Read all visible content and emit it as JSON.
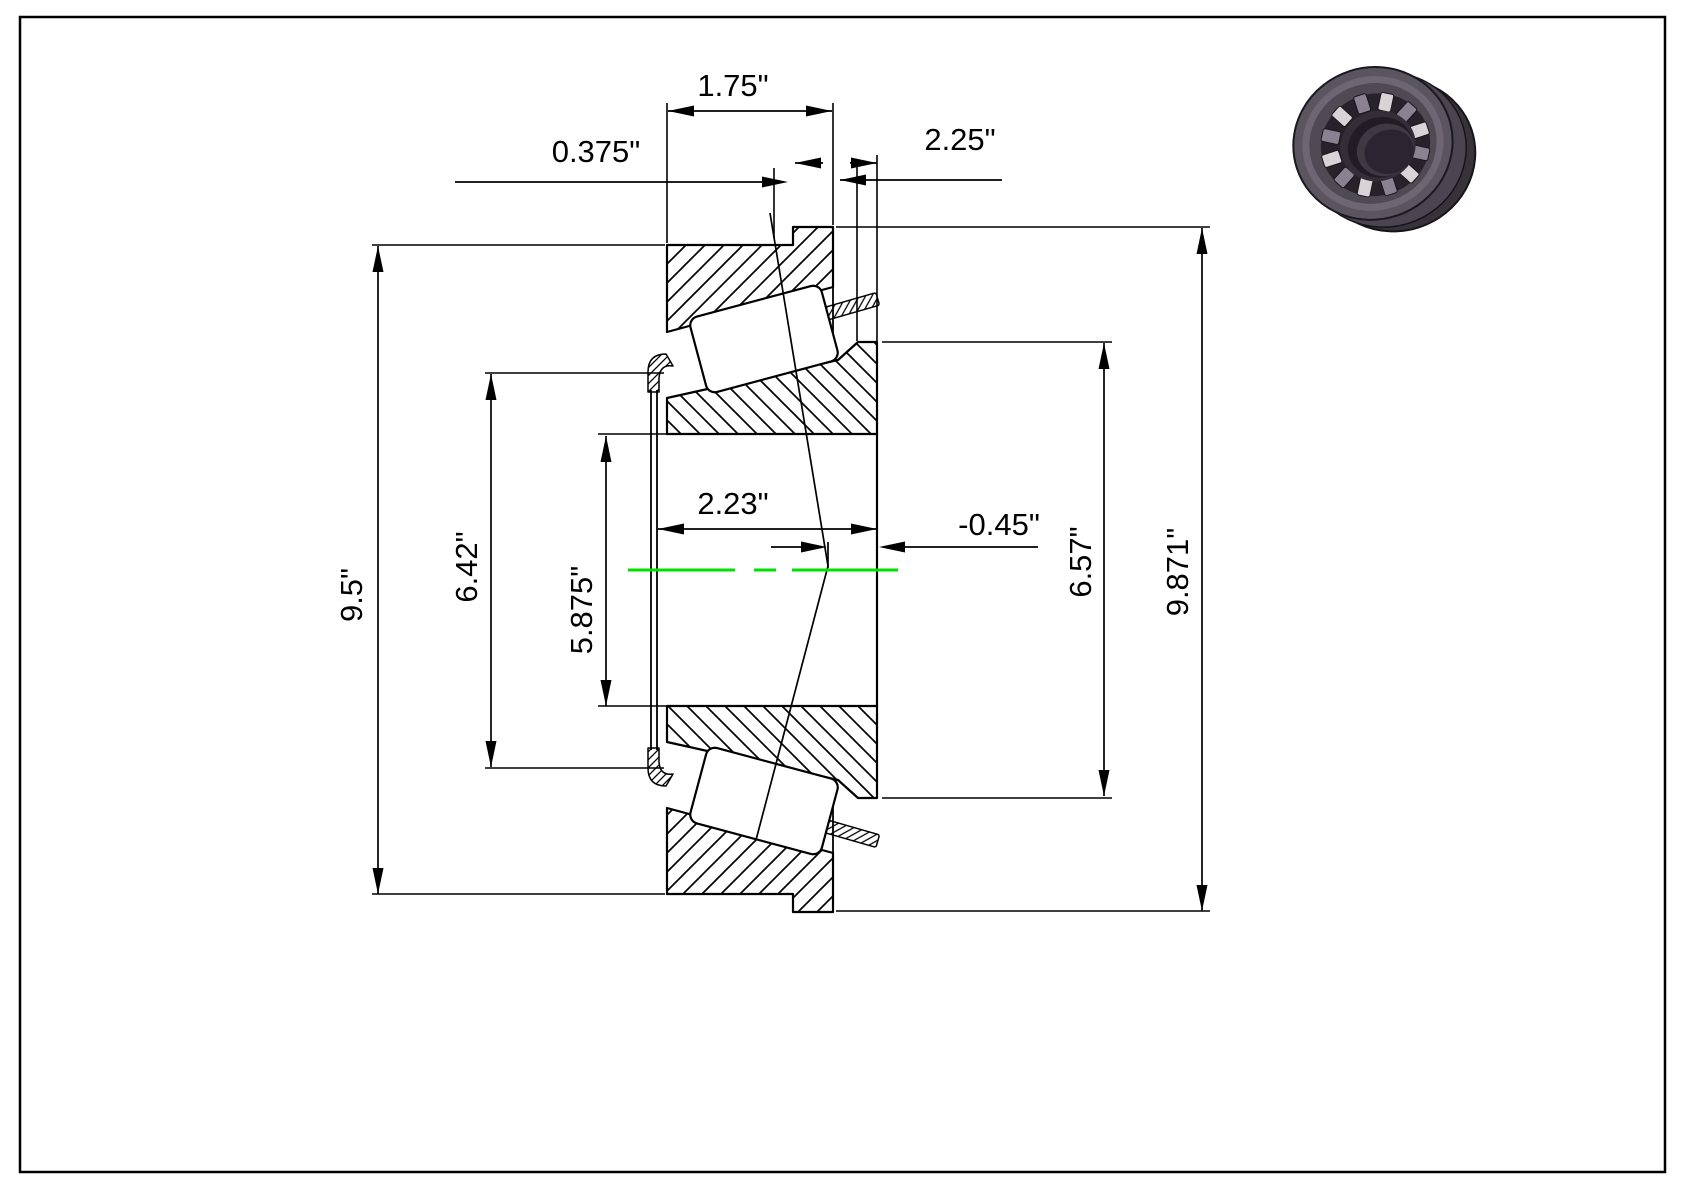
{
  "colors": {
    "line": "#000000",
    "centerline": "#00e000",
    "background": "#ffffff",
    "bearing_back": "#38333b",
    "bearing_mid": "#4a4550",
    "bearing_front": "#5b5560",
    "bearing_face": "#6e6773",
    "bearing_chamfer": "#504a55",
    "bearing_cavity": "#27222b",
    "bearing_cage": "#332e37",
    "bearing_bore_edge": "#211c25",
    "bearing_bore_wall": "#3f3944",
    "bearing_bore_depth": "#2a2530",
    "roller_light": "#d7d3d6",
    "roller_dark": "#8a8290"
  },
  "dimensions": {
    "top": [
      {
        "label": "1.75\""
      },
      {
        "label": "0.375\""
      },
      {
        "label": "2.25\""
      }
    ],
    "center": [
      {
        "label": "2.23\""
      },
      {
        "label": "-0.45\""
      }
    ],
    "left": [
      {
        "label": "9.5\""
      },
      {
        "label": "6.42\""
      },
      {
        "label": "5.875\""
      }
    ],
    "right": [
      {
        "label": "6.57\""
      },
      {
        "label": "9.871\""
      }
    ]
  },
  "illustration": {
    "icon": "tapered-roller-bearing-3d-render"
  }
}
